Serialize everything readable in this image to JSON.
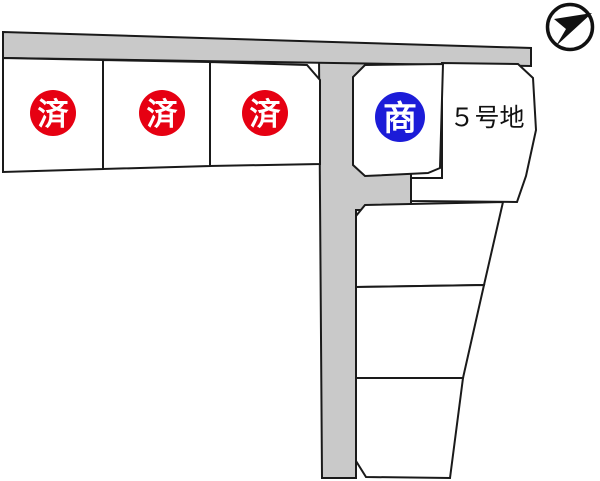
{
  "map": {
    "type_label": "lot-map",
    "lots": [
      {
        "id": "lot-1",
        "status": "済"
      },
      {
        "id": "lot-2",
        "status": "済"
      },
      {
        "id": "lot-3",
        "status": "済"
      },
      {
        "id": "lot-4",
        "status": "商"
      },
      {
        "id": "lot-5",
        "label": "５号地"
      },
      {
        "id": "lot-6",
        "label": ""
      },
      {
        "id": "lot-7",
        "label": ""
      },
      {
        "id": "lot-8",
        "label": ""
      }
    ],
    "colors": {
      "road": "#c9c9c9",
      "parcel": "#ffffff",
      "highlight": "#fbf8c8",
      "sold_badge": "#e60012",
      "negotiating_badge": "#1c1cd8",
      "line": "#1a1a1a",
      "background": "#ffffff"
    },
    "compass": {
      "icon": "north-arrow-icon"
    }
  }
}
